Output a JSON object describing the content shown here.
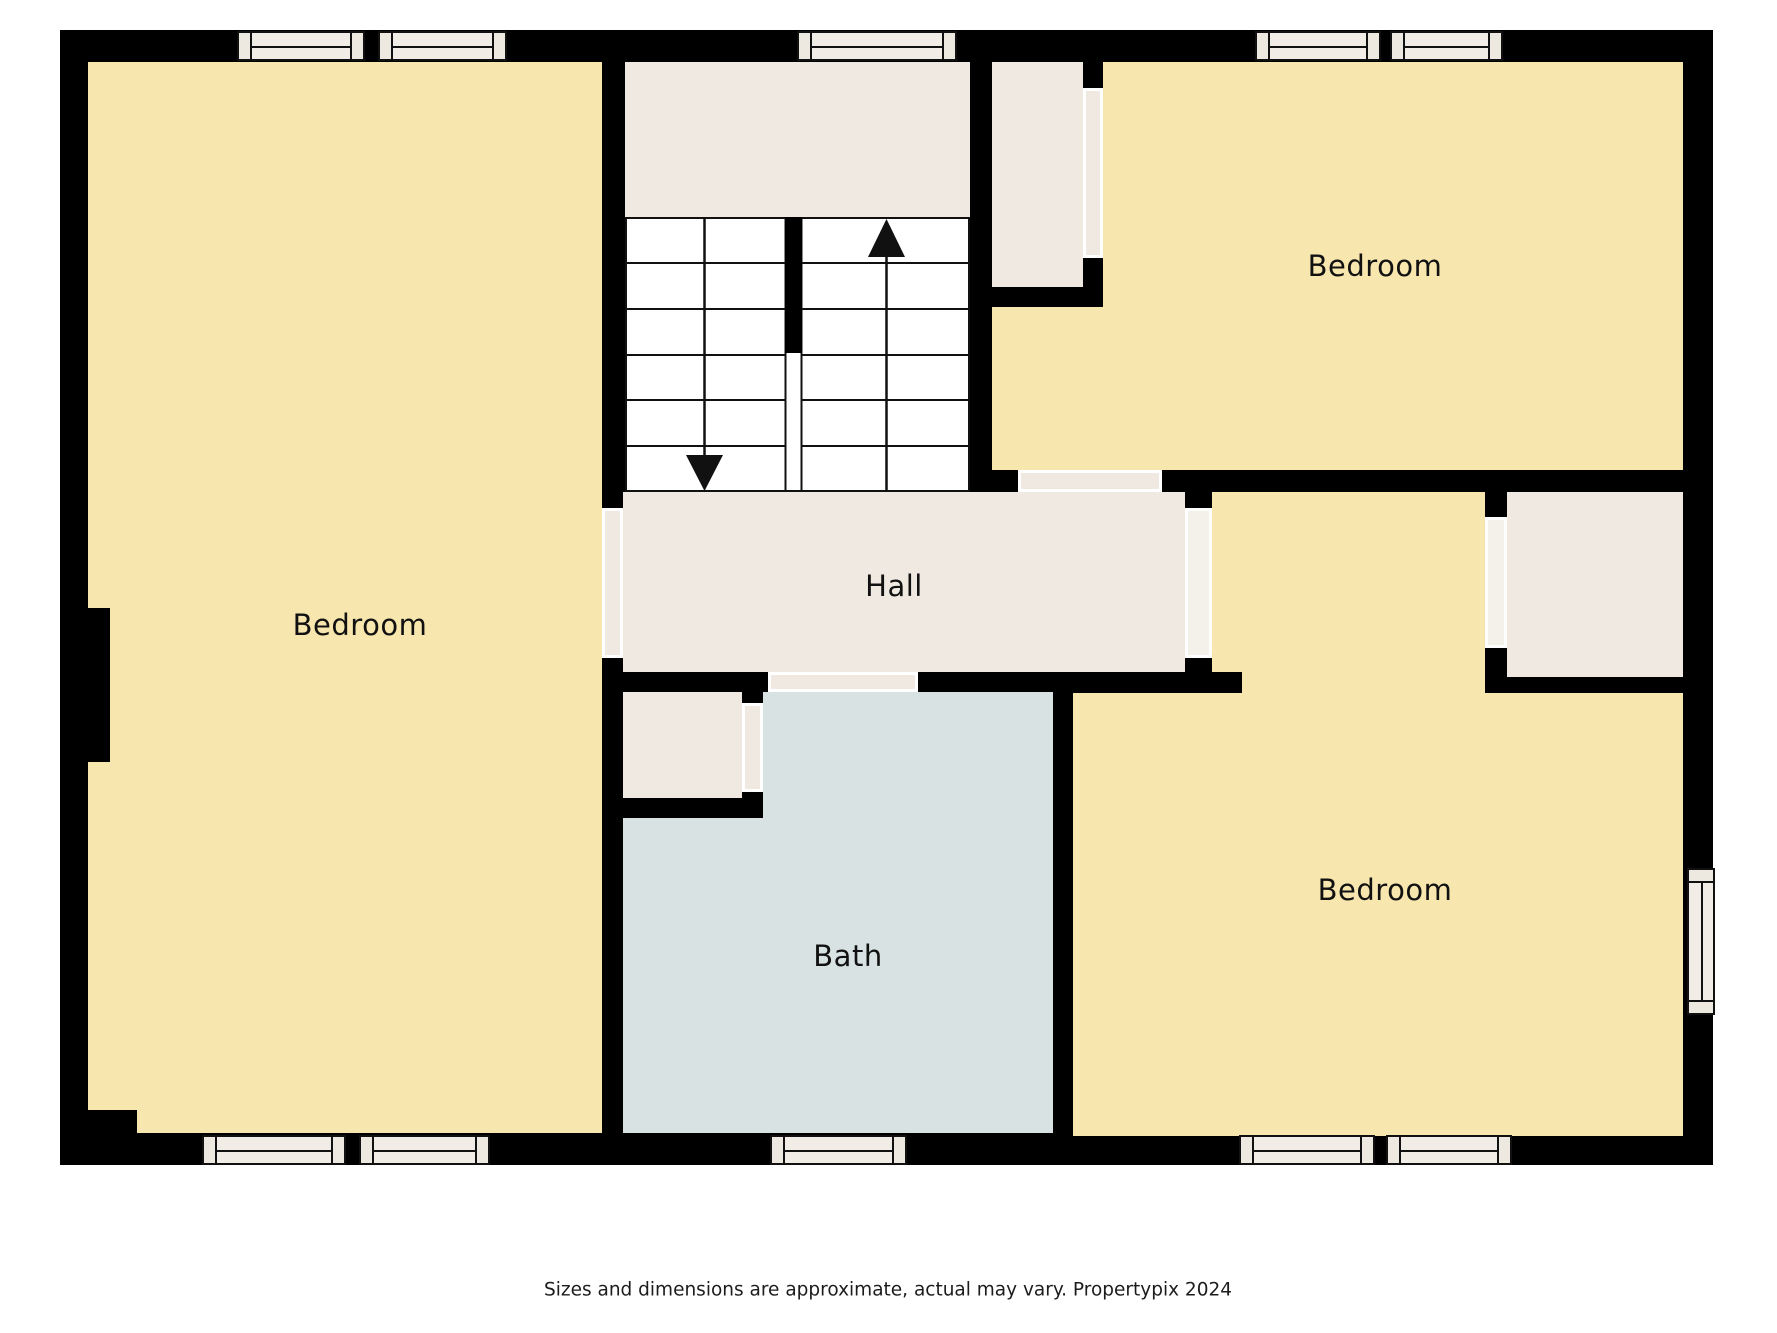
{
  "title": "Floor plan",
  "rooms": {
    "bedroom_left": {
      "label": "Bedroom"
    },
    "bedroom_top_right": {
      "label": "Bedroom"
    },
    "bedroom_bottom_right": {
      "label": "Bedroom"
    },
    "hall": {
      "label": "Hall"
    },
    "bath": {
      "label": "Bath"
    }
  },
  "stairs": {
    "up_arrow_icon": "stairs-up-arrow",
    "down_arrow_icon": "stairs-down-arrow"
  },
  "caption": "Sizes and dimensions are approximate, actual may vary. Propertypix 2024",
  "colors": {
    "wall": "#000000",
    "room_fill": "#f7e6ae",
    "hall_fill": "#f0e9e2",
    "bath_fill": "#d8e2e2",
    "window_fill": "#f1ece6",
    "background": "#ffffff",
    "text": "#111111"
  }
}
